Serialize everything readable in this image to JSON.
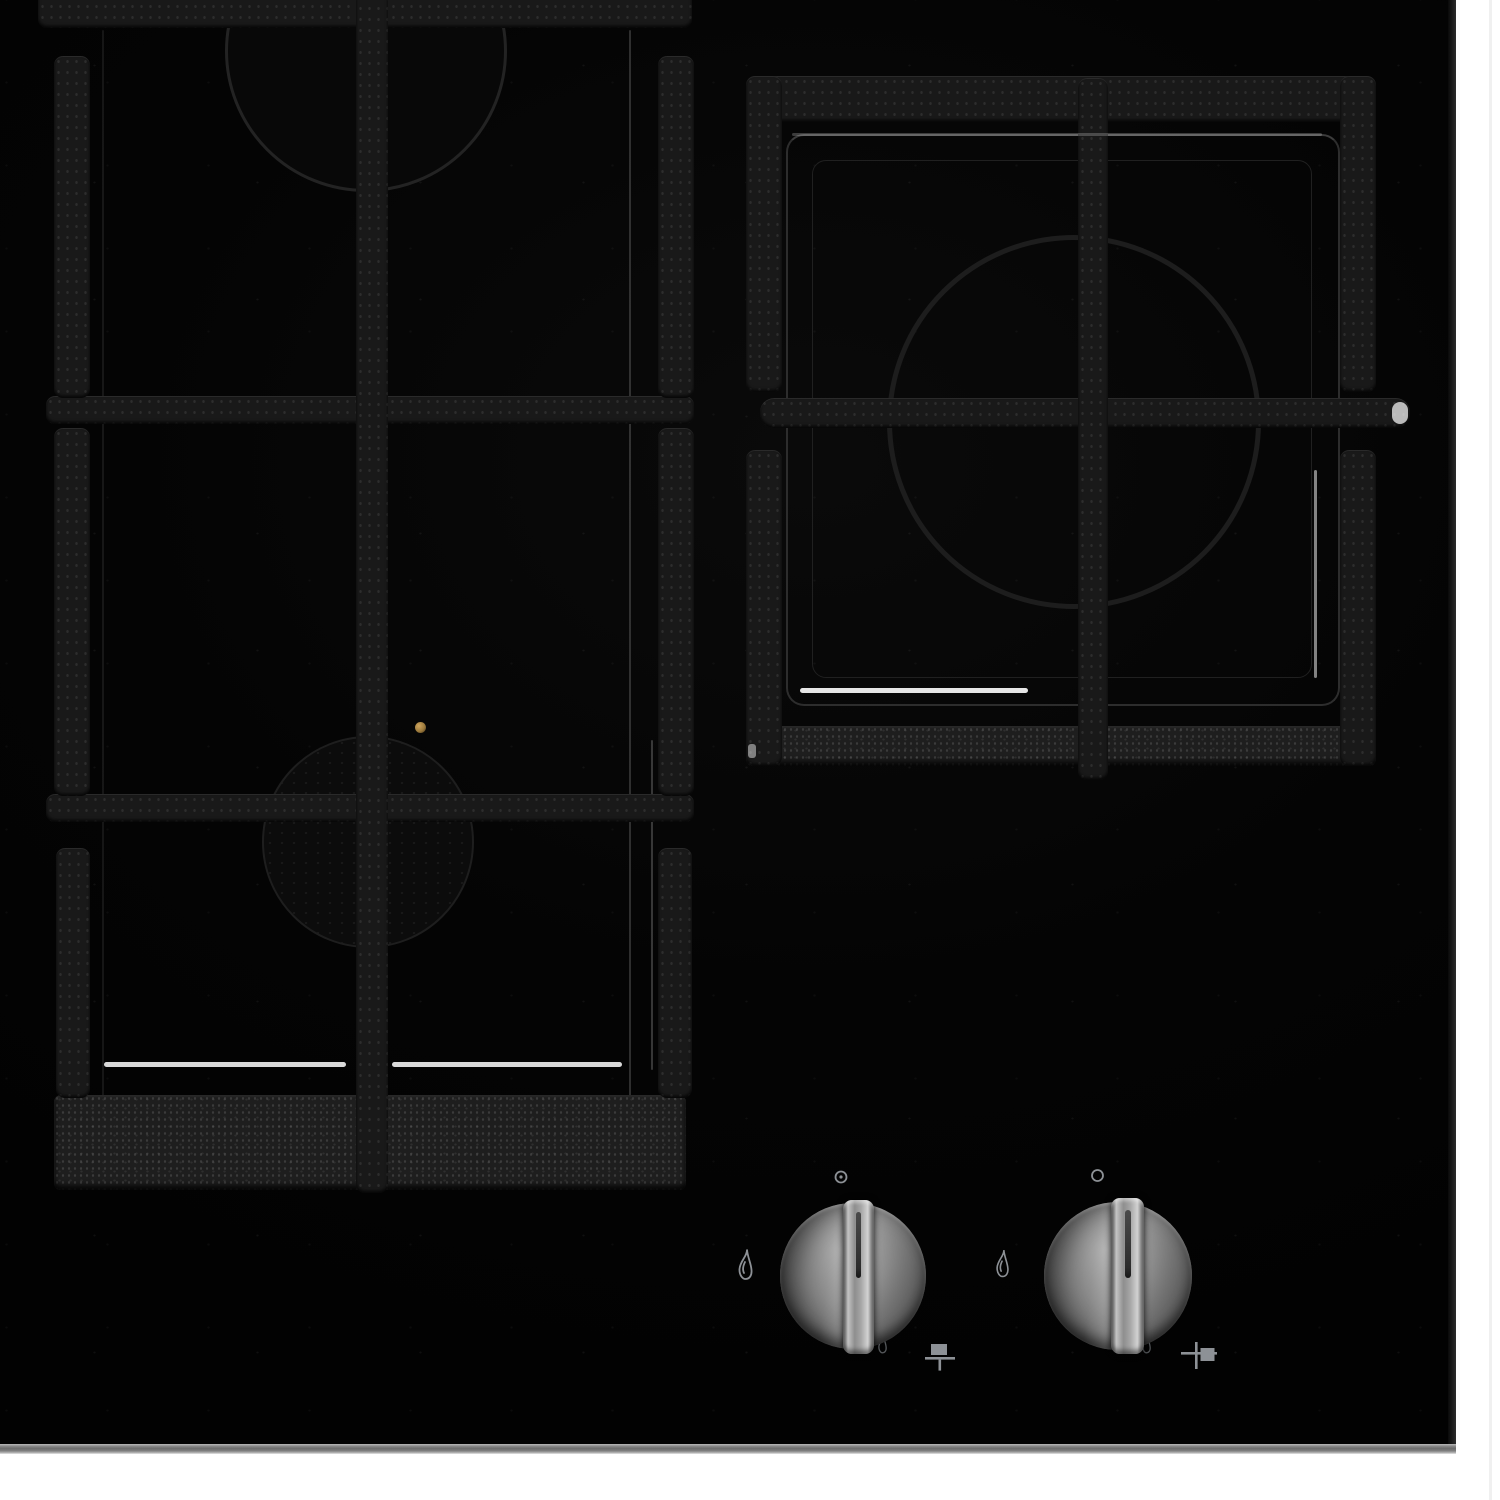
{
  "scene": {
    "type": "product-photo",
    "subject": "built-in black glass gas hob, top-down view, partially cropped",
    "elements": [
      "cast-iron pan supports",
      "three gas burner wells",
      "two stainless steel control knobs",
      "control markings printed on glass"
    ]
  },
  "surface": {
    "glass_color": "#050505",
    "glass_edge_color": "#7e7e7e",
    "backdrop_color": "#ffffff"
  },
  "pan_supports": [
    {
      "name": "left-double-pan-support",
      "material": "cast iron",
      "burners": [
        {
          "name": "rear-left-burner",
          "visibility": "partial, cropped at top"
        },
        {
          "name": "front-left-burner",
          "igniter_dot_color": "#9c7a3c"
        }
      ]
    },
    {
      "name": "right-single-pan-support",
      "material": "cast iron",
      "burners": [
        {
          "name": "right-burner"
        }
      ]
    }
  ],
  "controls": {
    "knobs": [
      {
        "name": "left-burner-knob",
        "finish": "brushed stainless steel",
        "state": "off, grip vertical",
        "markings": {
          "top": "off-position dot-in-circle",
          "left": "large flame",
          "bottom_right_small": "small flame",
          "bottom_right": "burner position pictogram (square over T)"
        }
      },
      {
        "name": "right-burner-knob",
        "finish": "brushed stainless steel",
        "state": "off, grip vertical",
        "markings": {
          "top": "off-position circle",
          "left": "large flame",
          "bottom_right_small": "small flame",
          "bottom_right": "burner position pictogram (cross with right square)"
        }
      }
    ]
  },
  "colors": {
    "icon_gray": "#8d9196",
    "icon_gray_dim": "#6f7377",
    "grate_iron": "#191919",
    "knob_metal_light": "#c4c4c4",
    "knob_metal_dark": "#474747",
    "highlight_white": "#ffffff",
    "igniter_brass": "#9c7a3c"
  }
}
